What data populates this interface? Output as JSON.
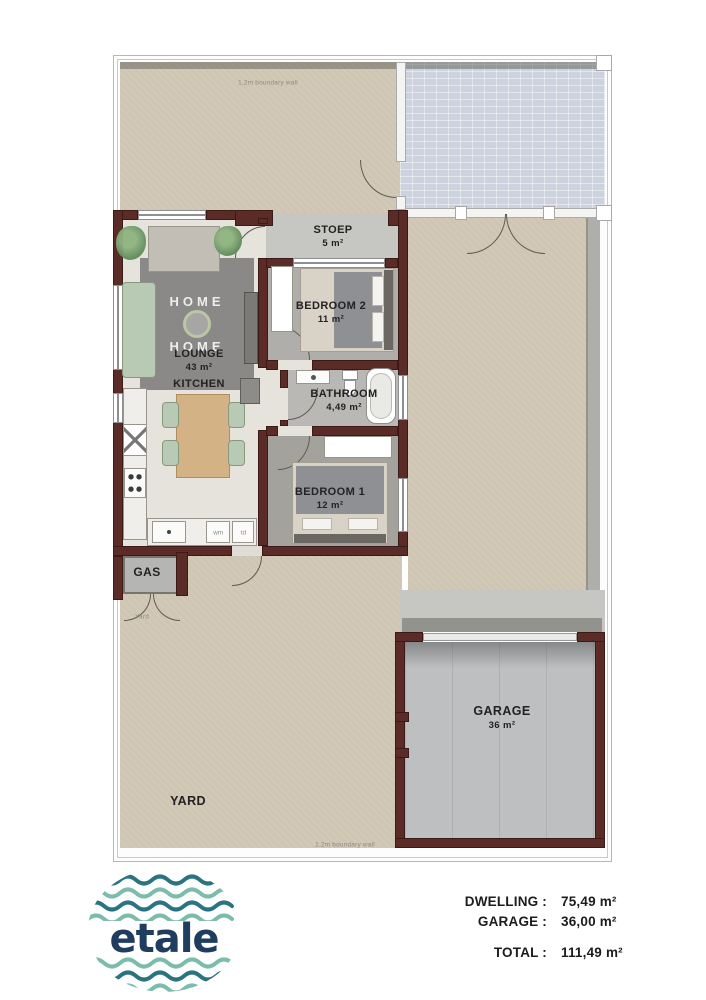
{
  "plan": {
    "boundary_label_top": "1.2m boundary wall",
    "boundary_label_bottom": "1.2m boundary wall",
    "rooms": {
      "stoep": {
        "name": "STOEP",
        "area": "5 m²"
      },
      "bedroom2": {
        "name": "BEDROOM 2",
        "area": "11 m²"
      },
      "bathroom": {
        "name": "BATHROOM",
        "area": "4,49 m²"
      },
      "bedroom1": {
        "name": "BEDROOM 1",
        "area": "12 m²"
      },
      "lounge": {
        "name": "LOUNGE",
        "area": "43 m²"
      },
      "kitchen": {
        "name": "KITCHEN"
      },
      "gas": {
        "name": "GAS"
      },
      "yard": {
        "name": "YARD",
        "small": "Yard"
      },
      "garage": {
        "name": "GARAGE",
        "area": "36 m²"
      }
    },
    "appliances": {
      "washing_machine": "wm",
      "tumble_dryer": "td"
    },
    "rug": {
      "line1": "HOME",
      "line2": "HOME"
    }
  },
  "legend": {
    "rows": [
      {
        "label": "DWELLING :",
        "value": "75,49 m²"
      },
      {
        "label": "GARAGE :",
        "value": "36,00 m²"
      }
    ],
    "total": {
      "label": "TOTAL :",
      "value": "111,49 m²"
    }
  },
  "logo": {
    "text": "etale"
  },
  "colors": {
    "wall": "#5b2b27",
    "yard": "#cfc5b3",
    "paving": "#ccd3de",
    "wave_dark": "#2a7383",
    "wave_light": "#7cbcab",
    "logo_text": "#1e3d5f"
  }
}
